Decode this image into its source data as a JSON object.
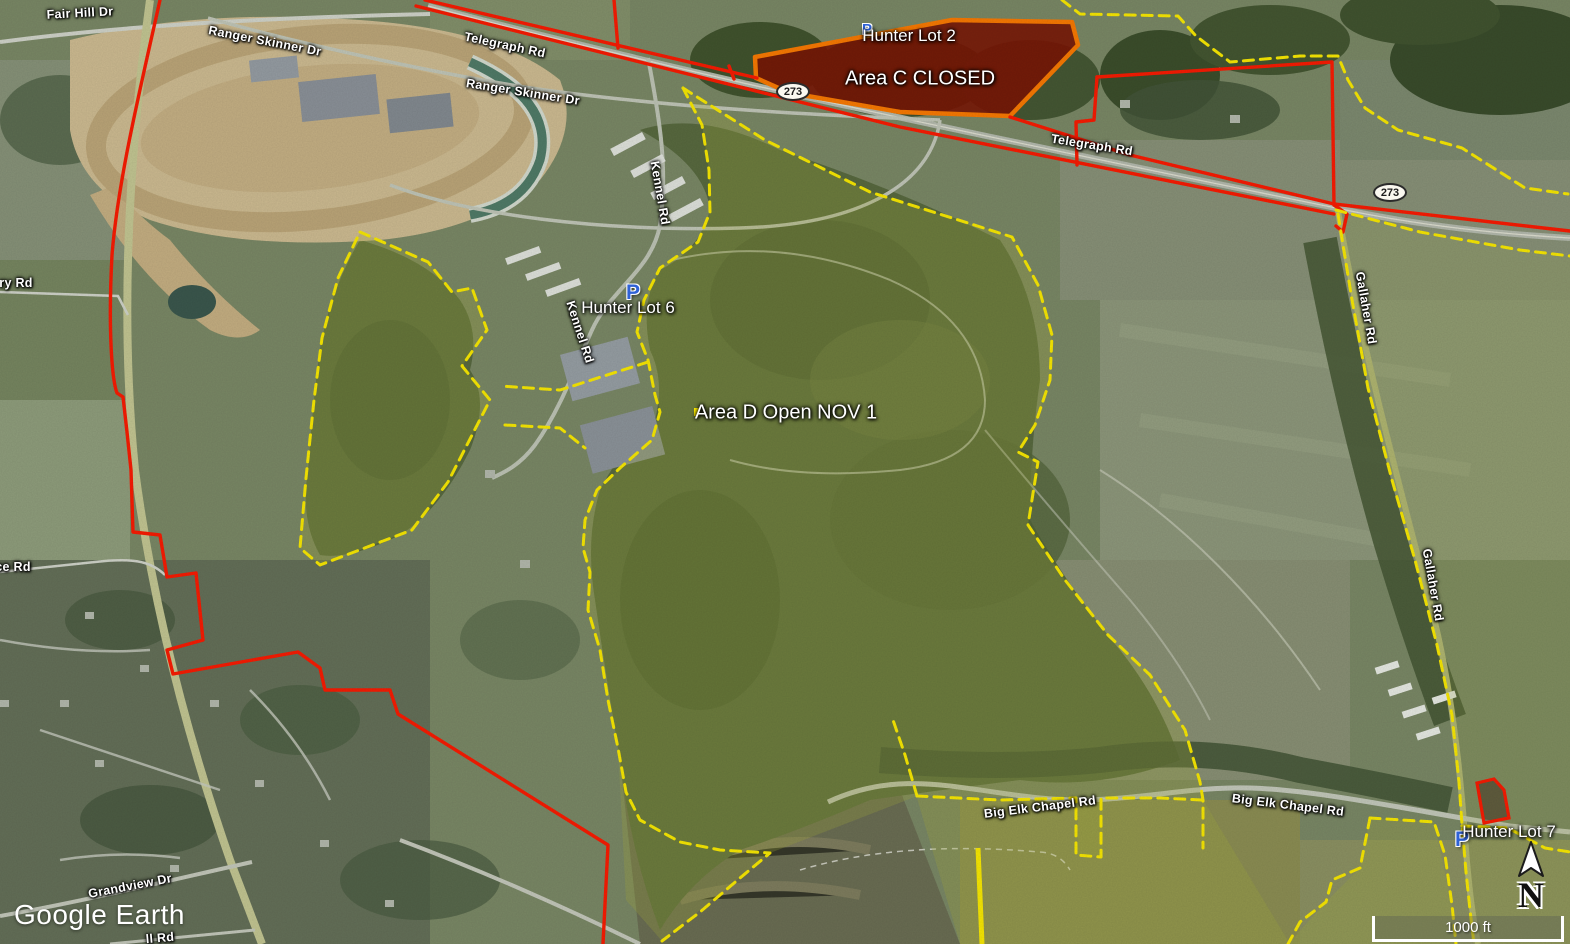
{
  "app": {
    "watermark": "Google Earth"
  },
  "map": {
    "route_shield": "273",
    "area_labels": {
      "area_c": "Area C CLOSED",
      "area_d": "Area D Open NOV 1"
    },
    "parking_icon_letter": "P",
    "parking_lots": {
      "lot2": "Hunter Lot 2",
      "lot6": "Hunter Lot 6",
      "lot7": "Hunter Lot 7"
    },
    "road_labels": {
      "fair_hill_dr": "Fair Hill Dr",
      "ranger_skinner_dr": "Ranger Skinner Dr",
      "telegraph_rd": "Telegraph Rd",
      "kennel_rd": "Kennel Rd",
      "gallaher_rd": "Gallaher Rd",
      "big_elk_chapel_rd": "Big Elk Chapel Rd",
      "grandview_dr": "Grandview Dr",
      "partial_ry_rd": "ry Rd",
      "partial_ce_rd": "ce Rd",
      "partial_ll_rd": "ll Rd"
    }
  },
  "hud": {
    "scale_label": "1000 ft",
    "north_label": "N"
  },
  "colors": {
    "boundary_red": "#ff1a00",
    "boundary_yellow": "#ffee00",
    "closed_area_fill": "#7c1403",
    "closed_area_border": "#ff7b00",
    "open_area_tint": "#aab23c",
    "parking_blue": "#2f62d6",
    "label_white": "#ffffff"
  }
}
